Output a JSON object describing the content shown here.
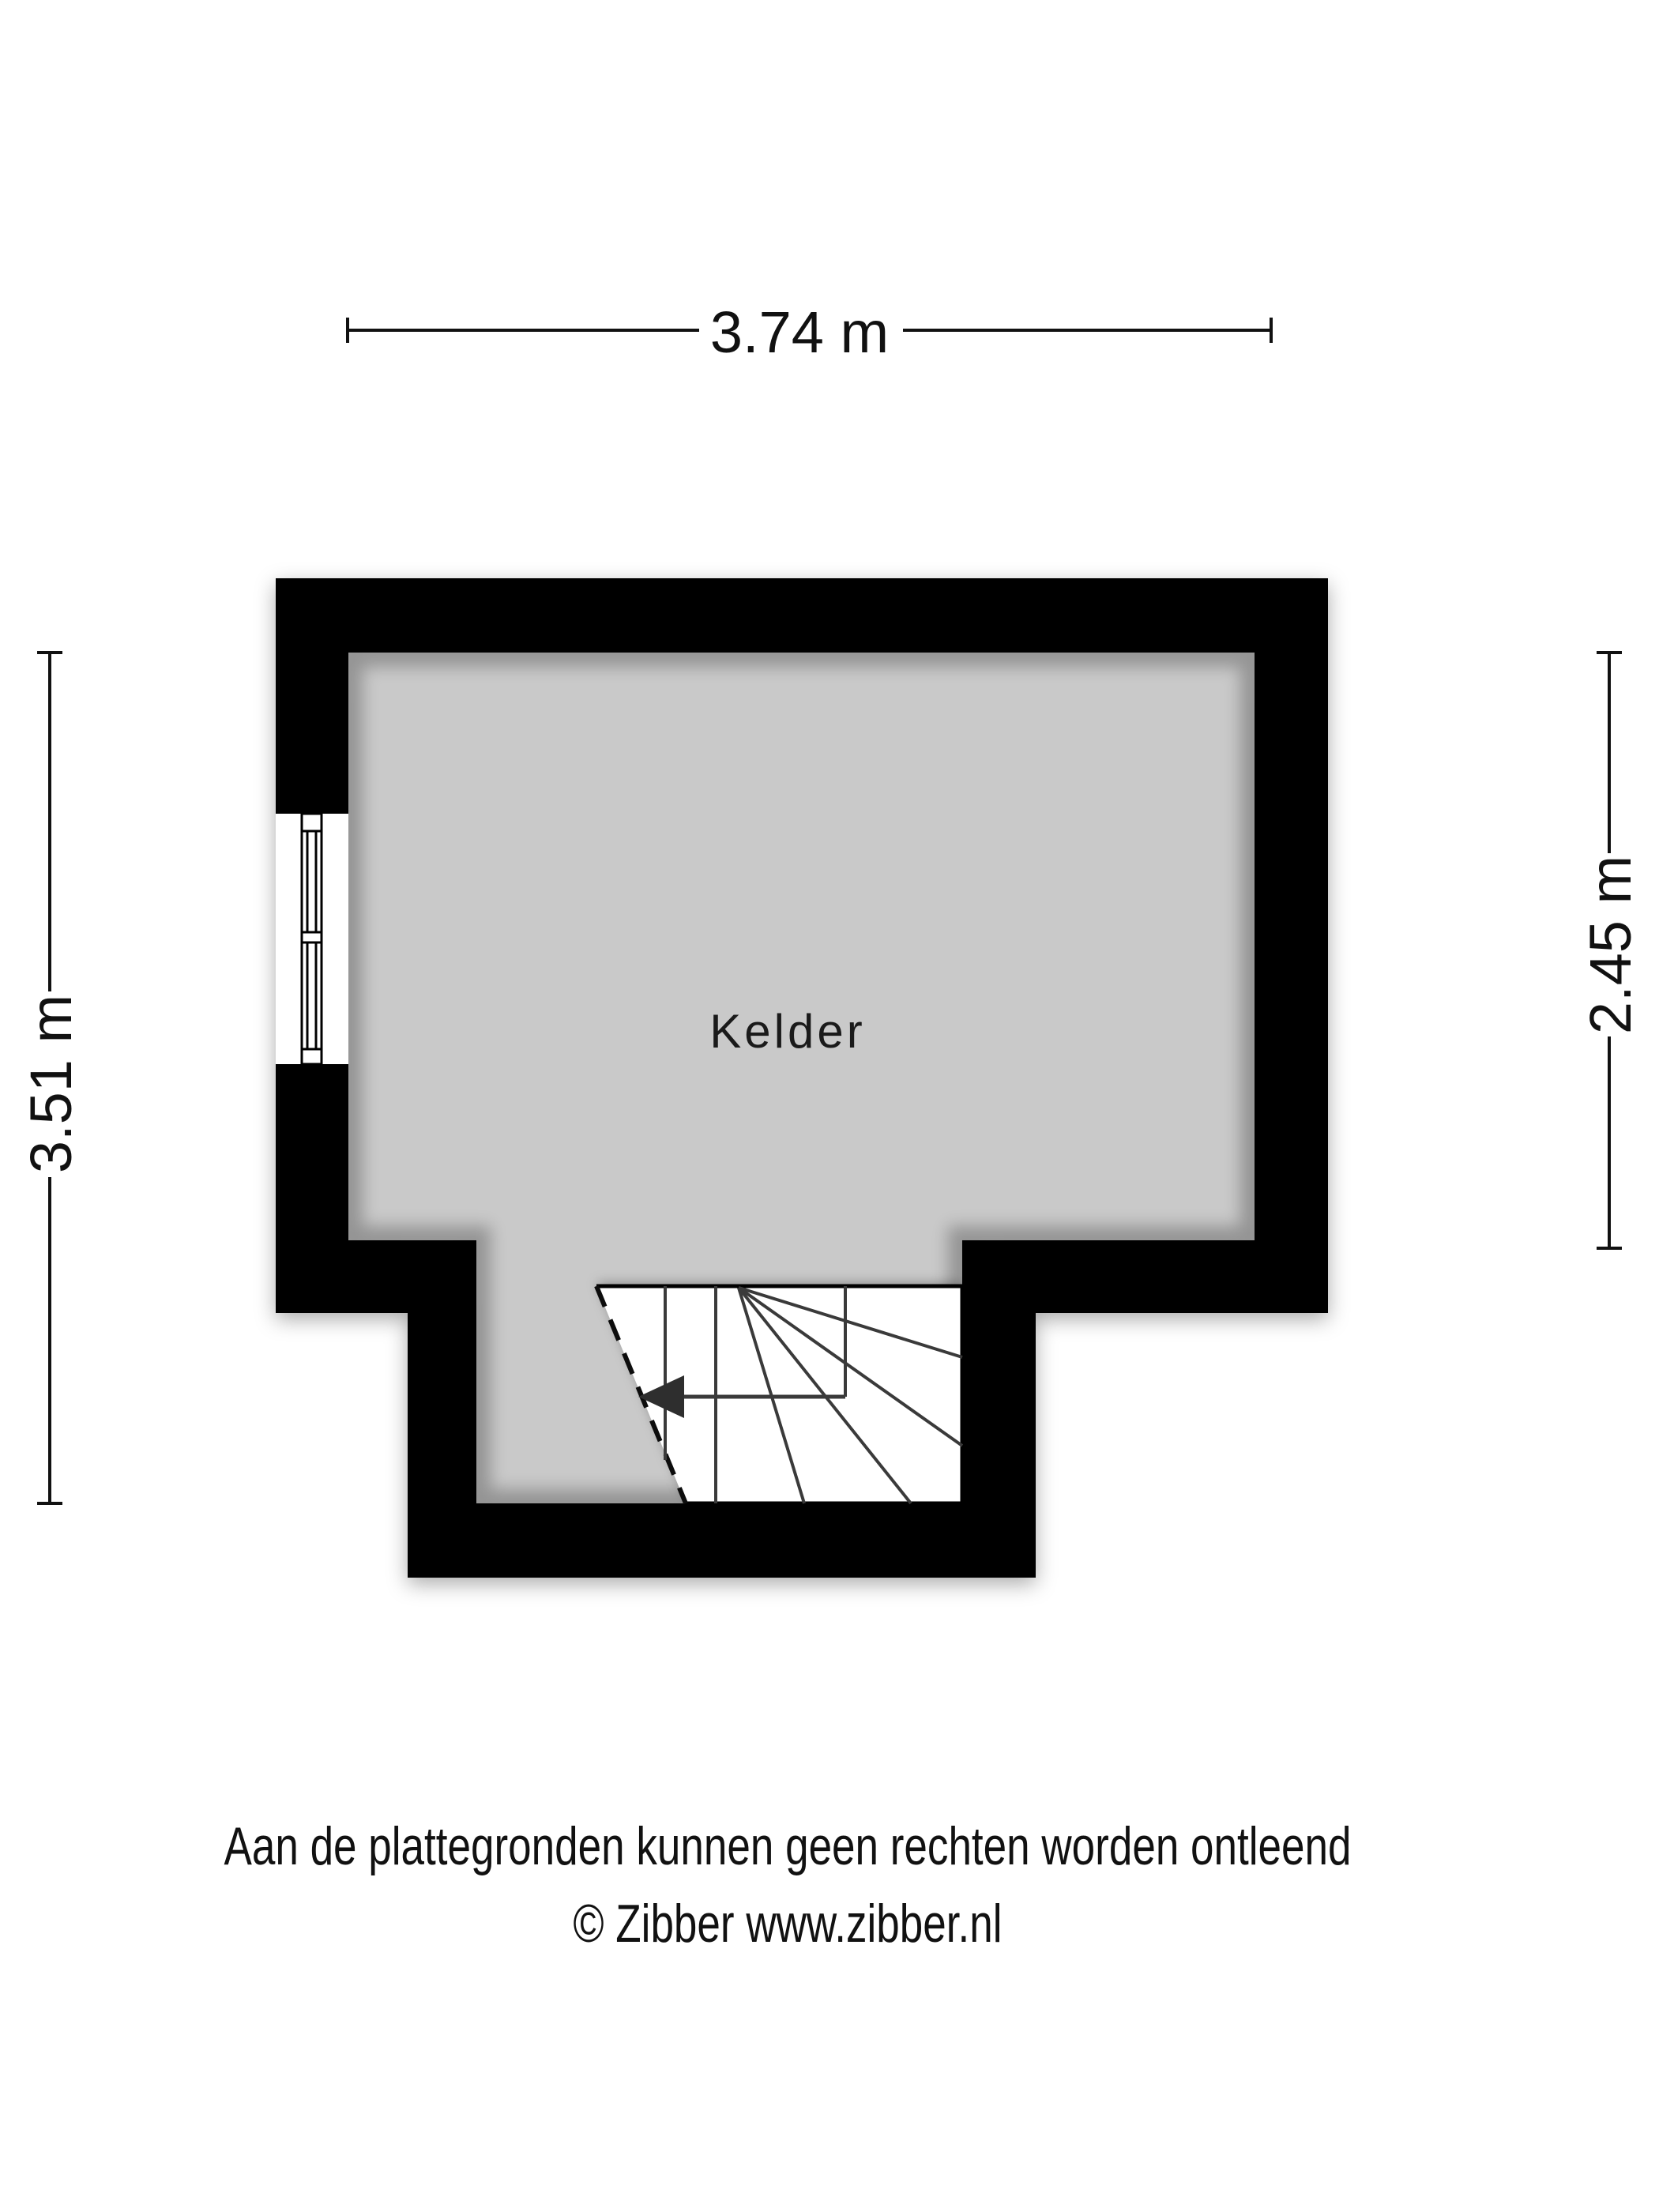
{
  "plan": {
    "type": "floorplan",
    "floor_label": "Kelder",
    "rooms": [
      {
        "name": "Kelder"
      }
    ],
    "features": [
      {
        "name": "window",
        "wall": "left"
      },
      {
        "name": "winder-staircase",
        "location": "bottom",
        "direction_arrow": "left"
      }
    ]
  },
  "dimensions": {
    "top": "3.74 m",
    "left": "3.51 m",
    "right": "2.45 m"
  },
  "footer": {
    "line1": "Aan de plattegronden kunnen geen rechten worden ontleend",
    "line2": "© Zibber www.zibber.nl"
  },
  "colors": {
    "wall": "#000000",
    "floor": "#c9c9c9",
    "background": "#ffffff",
    "stair_area": "#ffffff",
    "stair_line": "#3a3a3a",
    "text": "#111111"
  }
}
